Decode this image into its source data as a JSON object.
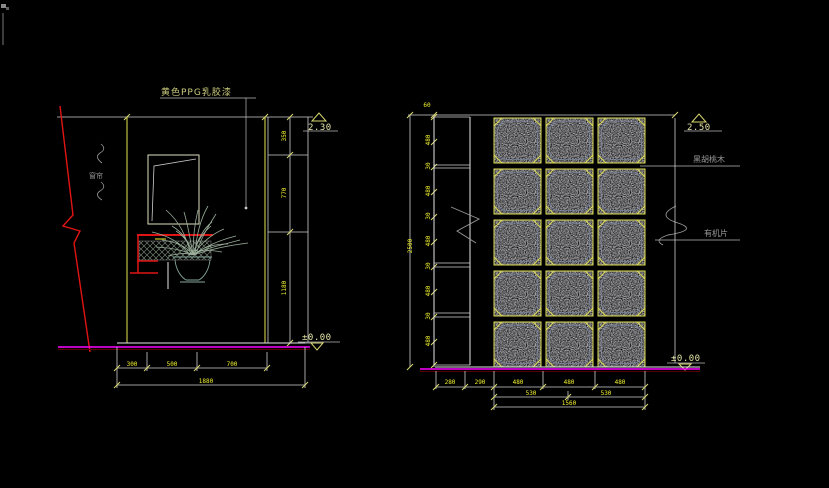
{
  "colors": {
    "background": "#000000",
    "dim_text_yellow": "#f2f230",
    "panel_yellow": "#cfcf4a",
    "ground_magenta": "#ff00ff",
    "cut_red": "#e01414",
    "line_white": "#cfcfcf",
    "label_gray": "#9a9a9a",
    "paint_label_yellow": "#cbcb7e",
    "elevation_text": "#e6e6a8"
  },
  "left_view": {
    "paint_label": "黄色PPG乳胶漆",
    "side_label": "窗帘",
    "elevation_top": "2.30",
    "elevation_bottom": "±0.00",
    "right_dims": [
      "350",
      "770",
      "1180"
    ],
    "bottom_dims": [
      "300",
      "500",
      "700"
    ],
    "bottom_overall": "1880"
  },
  "right_view": {
    "elevation_top": "2.50",
    "elevation_bottom": "±0.00",
    "material_top": "黑胡桃木",
    "material_bottom": "有机片",
    "top_dim": "60",
    "overall_height": "2500",
    "chain_dims": [
      "480",
      "30",
      "480",
      "30",
      "480",
      "30",
      "480",
      "30",
      "480"
    ],
    "strip_dims": [
      "280",
      "290"
    ],
    "bottom_dims": [
      "480",
      "480",
      "480"
    ],
    "bottom_dims2": [
      "530",
      "530"
    ],
    "bottom_overall": "1560"
  }
}
